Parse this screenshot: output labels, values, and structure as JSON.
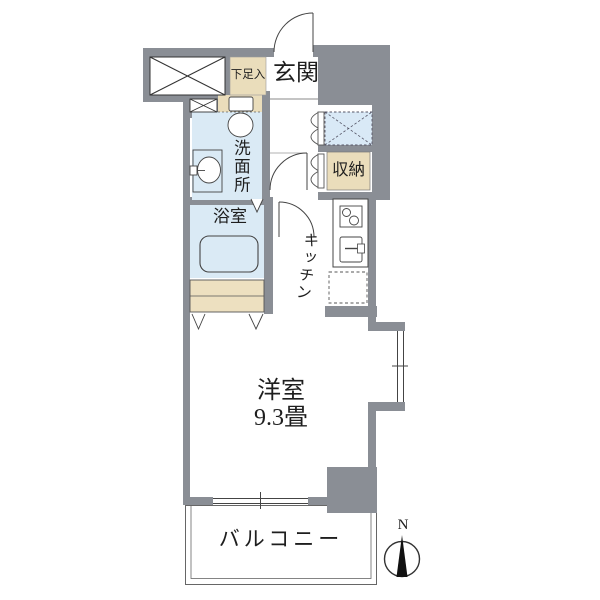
{
  "plan": {
    "rooms": {
      "entrance": {
        "label": "玄関"
      },
      "shoe_cabinet": {
        "label": "下足入"
      },
      "washroom": {
        "label": "洗面所"
      },
      "bathroom": {
        "label": "浴室"
      },
      "storage": {
        "label": "収納"
      },
      "kitchen": {
        "label": "キッチン"
      },
      "main_room": {
        "label": "洋室",
        "size": "9.3畳"
      },
      "balcony": {
        "label": "バルコニー"
      }
    },
    "compass": {
      "north_label": "N"
    },
    "colors": {
      "wall": "#8a8e95",
      "wet_area_fill": "#daeaf5",
      "cabinet_fill": "#eaddbb",
      "outline": "#444444"
    }
  }
}
